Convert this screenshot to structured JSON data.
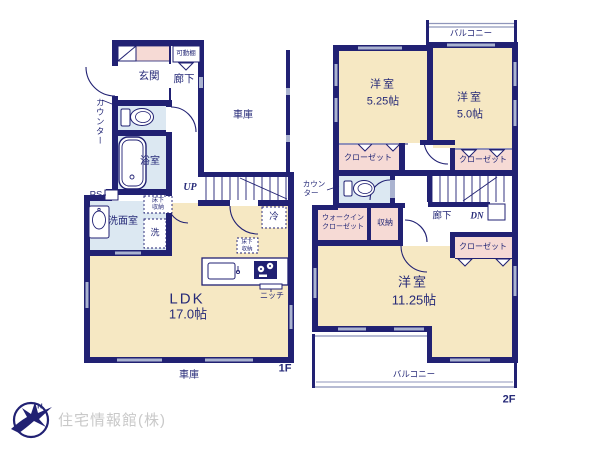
{
  "plan": {
    "floor1": {
      "floor_label": "1F",
      "rooms": {
        "genkan": "玄関",
        "hallway": "廊下",
        "movable_shelf": "可動棚",
        "counter": "カウンター",
        "bathroom": "浴室",
        "pipe_space": "PS",
        "washroom": "洗面室",
        "washer": "洗",
        "underfloor_line1": "床下",
        "underfloor_line2": "収納",
        "stairs_up": "UP",
        "fridge": "冷",
        "ldk": "LDK",
        "ldk_size": "17.0帖",
        "niche": "ニッチ",
        "garage": "車庫"
      }
    },
    "floor2": {
      "floor_label": "2F",
      "rooms": {
        "balcony": "バルコニー",
        "western_room": "洋室",
        "room_5_25": "5.25帖",
        "room_5_0": "5.0帖",
        "room_11_25": "11.25帖",
        "closet": "クローゼット",
        "wic_line1": "ウォークイン",
        "wic_line2": "クローゼット",
        "storage": "収納",
        "counter_line1": "カウン",
        "counter_line2": "ター",
        "hallway": "廊下",
        "stairs_down": "DN"
      }
    }
  },
  "logo": {
    "company": "住宅情報館(株)",
    "compass_north": "N"
  },
  "colors": {
    "wall": "#212173",
    "room_cream": "#f6e8c3",
    "wet_blue": "#dce8f2",
    "closet_pink": "#f6dad5",
    "window_gray": "#aab3d0",
    "balcony_line": "#8f96bb",
    "text_navy": "#262a78",
    "logo_gray": "#c9c9c9"
  }
}
